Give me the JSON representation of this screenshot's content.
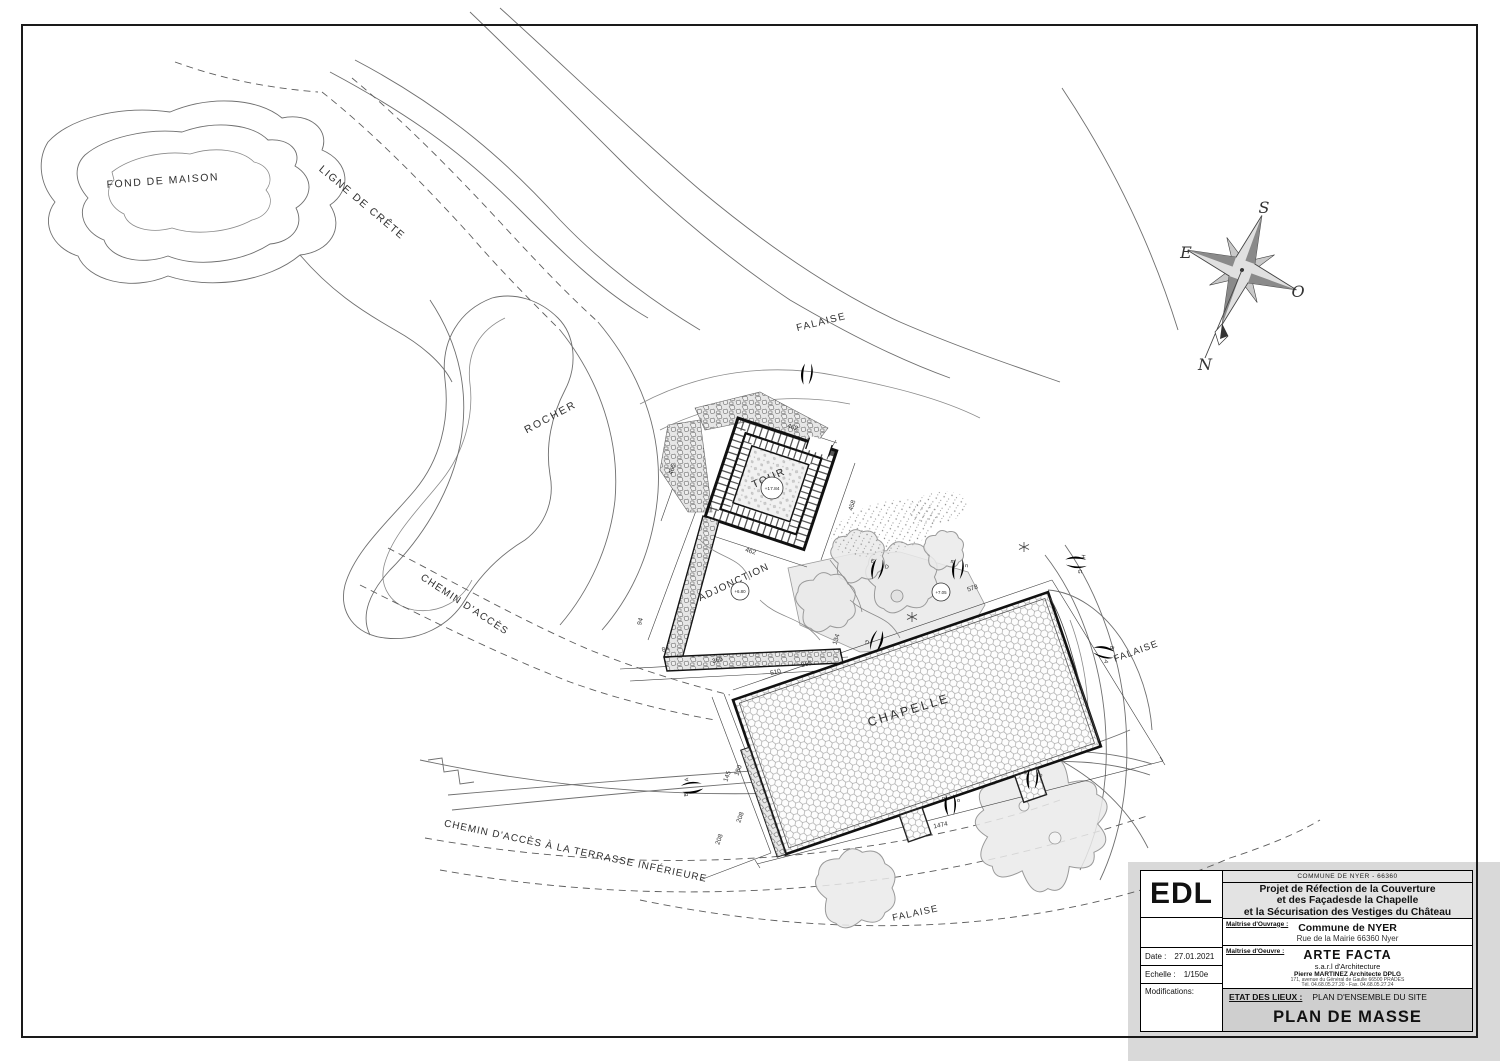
{
  "document": {
    "kind": "architectural site plan",
    "paper_color": "#ffffff",
    "panel_gray": "#d9d9d9"
  },
  "map": {
    "compass": {
      "south": "S",
      "east": "E",
      "west": "O",
      "north": "N"
    },
    "labels": [
      {
        "name": "fond-de-maison",
        "text": "FOND DE MAISON",
        "x": 163,
        "y": 184,
        "rot": -4,
        "size": 10.5,
        "ls": 1.5
      },
      {
        "name": "ligne-de-crete",
        "text": "LIGNE DE CRÊTE",
        "x": 360,
        "y": 205,
        "rot": 40,
        "size": 10.5,
        "ls": 1.5
      },
      {
        "name": "falaise-haut",
        "text": "FALAISE",
        "x": 822,
        "y": 325,
        "rot": -14,
        "size": 10,
        "ls": 1.5
      },
      {
        "name": "rocher",
        "text": "ROCHER",
        "x": 552,
        "y": 420,
        "rot": -28,
        "size": 10.5,
        "ls": 2
      },
      {
        "name": "chemin-acces",
        "text": "CHEMIN D'ACCÈS",
        "x": 463,
        "y": 607,
        "rot": 33,
        "size": 10,
        "ls": 1.2
      },
      {
        "name": "tour",
        "text": "TOUR",
        "x": 770,
        "y": 481,
        "rot": -24,
        "size": 10.5,
        "ls": 1.5
      },
      {
        "name": "adjonction",
        "text": "ADJONCTION",
        "x": 735,
        "y": 585,
        "rot": -25,
        "size": 10,
        "ls": 1.2
      },
      {
        "name": "chapelle",
        "text": "CHAPELLE",
        "x": 910,
        "y": 714,
        "rot": -17,
        "size": 12.5,
        "ls": 2.5
      },
      {
        "name": "falaise-droite",
        "text": "FALAISE",
        "x": 1137,
        "y": 654,
        "rot": -20,
        "size": 9.5,
        "ls": 1.2
      },
      {
        "name": "chemin-terrasse",
        "text": "CHEMIN D'ACCÈS À LA TERRASSE INFÉRIEURE",
        "x": 575,
        "y": 854,
        "rot": 12,
        "size": 10,
        "ls": 1
      },
      {
        "name": "falaise-bas",
        "text": "FALAISE",
        "x": 916,
        "y": 916,
        "rot": -12,
        "size": 9.5,
        "ls": 1.2
      }
    ],
    "dimensions": [
      {
        "value": "462",
        "x": 792,
        "y": 429,
        "rot": 18
      },
      {
        "value": "466",
        "x": 674,
        "y": 470,
        "rot": -73
      },
      {
        "value": "462",
        "x": 750,
        "y": 553,
        "rot": 18
      },
      {
        "value": "458",
        "x": 854,
        "y": 506,
        "rot": -73
      },
      {
        "value": "94",
        "x": 642,
        "y": 622,
        "rot": -75
      },
      {
        "value": "84",
        "x": 666,
        "y": 651,
        "rot": -17
      },
      {
        "value": "366",
        "x": 718,
        "y": 662,
        "rot": -15
      },
      {
        "value": "510",
        "x": 776,
        "y": 674,
        "rot": -14
      },
      {
        "value": "365",
        "x": 807,
        "y": 666,
        "rot": -14
      },
      {
        "value": "134",
        "x": 838,
        "y": 640,
        "rot": -72
      },
      {
        "value": "578",
        "x": 973,
        "y": 590,
        "rot": -17
      },
      {
        "value": "1474",
        "x": 941,
        "y": 827,
        "rot": -12
      },
      {
        "value": "145",
        "x": 729,
        "y": 777,
        "rot": -70
      },
      {
        "value": "180",
        "x": 740,
        "y": 771,
        "rot": -70
      },
      {
        "value": "208",
        "x": 742,
        "y": 818,
        "rot": -70
      },
      {
        "value": "208",
        "x": 721,
        "y": 840,
        "rot": -70
      }
    ],
    "elevation_markers": [
      {
        "name": "tour-elevation",
        "text": "+17.84",
        "x": 772,
        "y": 488,
        "r": 11
      },
      {
        "name": "adjonction-elevation",
        "text": "+6.80",
        "x": 740,
        "y": 591,
        "r": 9
      },
      {
        "name": "terrasse-elevation",
        "text": "+7.05",
        "x": 941,
        "y": 592,
        "r": 9
      }
    ],
    "photo_markers": [
      {
        "x": 806,
        "y": 385,
        "rot": 8,
        "letters": [
          "",
          ""
        ]
      },
      {
        "x": 875,
        "y": 580,
        "rot": 15,
        "letters": [
          "E",
          "D"
        ]
      },
      {
        "x": 957,
        "y": 580,
        "rot": 8,
        "letters": [
          "m",
          "n"
        ]
      },
      {
        "x": 1065,
        "y": 562,
        "rot": 95,
        "letters": [
          "H",
          "G"
        ]
      },
      {
        "x": 1093,
        "y": 650,
        "rot": 105,
        "letters": [
          "B",
          "A"
        ]
      },
      {
        "x": 880,
        "y": 630,
        "rot": 200,
        "letters": [
          "H",
          "G"
        ]
      },
      {
        "x": 703,
        "y": 786,
        "rot": 265,
        "letters": [
          "B",
          "A"
        ]
      },
      {
        "x": 951,
        "y": 816,
        "rot": 0,
        "letters": [
          "n",
          "o"
        ]
      },
      {
        "x": 1032,
        "y": 790,
        "rot": 5,
        "letters": [
          "p",
          "o"
        ]
      }
    ],
    "vegetation": [
      {
        "x": 1040,
        "y": 824,
        "r": 64
      },
      {
        "x": 856,
        "y": 888,
        "r": 40
      },
      {
        "x": 902,
        "y": 577,
        "r": 36
      },
      {
        "x": 858,
        "y": 556,
        "r": 27
      },
      {
        "x": 944,
        "y": 550,
        "r": 20
      },
      {
        "x": 826,
        "y": 602,
        "r": 30
      }
    ]
  },
  "titleblock": {
    "code": "EDL",
    "commune_line": "COMMUNE DE NYER - 66360",
    "project_title_lines": [
      "Projet de Réfection de la Couverture",
      "et des Façadesde la Chapelle",
      "et la Sécurisation des Vestiges du Château"
    ],
    "ouvrage_label": "Maîtrise d'Ouvrage :",
    "ouvrage_name": "Commune de NYER",
    "ouvrage_address": "Rue de la Mairie 66360 Nyer",
    "oeuvre_label": "Maîtrise d'Oeuvre :",
    "oeuvre_name": "ARTE FACTA",
    "oeuvre_subtitle": "s.a.r.l d'Architecture",
    "architect": "Pierre MARTINEZ Architecte DPLG",
    "architect_address": "171, avenue du Général de Gaulle 66500 PRADES",
    "architect_phone": "Tél. 04.68.05.27.20 - Fax. 04.68.05.27.24",
    "date_label": "Date :",
    "date_value": "27.01.2021",
    "echelle_label": "Echelle :",
    "echelle_value": "1/150e",
    "modifications_label": "Modifications:",
    "phase_label": "ETAT DES LIEUX :",
    "phase_title": "PLAN D'ENSEMBLE DU SITE",
    "drawing_title": "PLAN DE MASSE"
  }
}
